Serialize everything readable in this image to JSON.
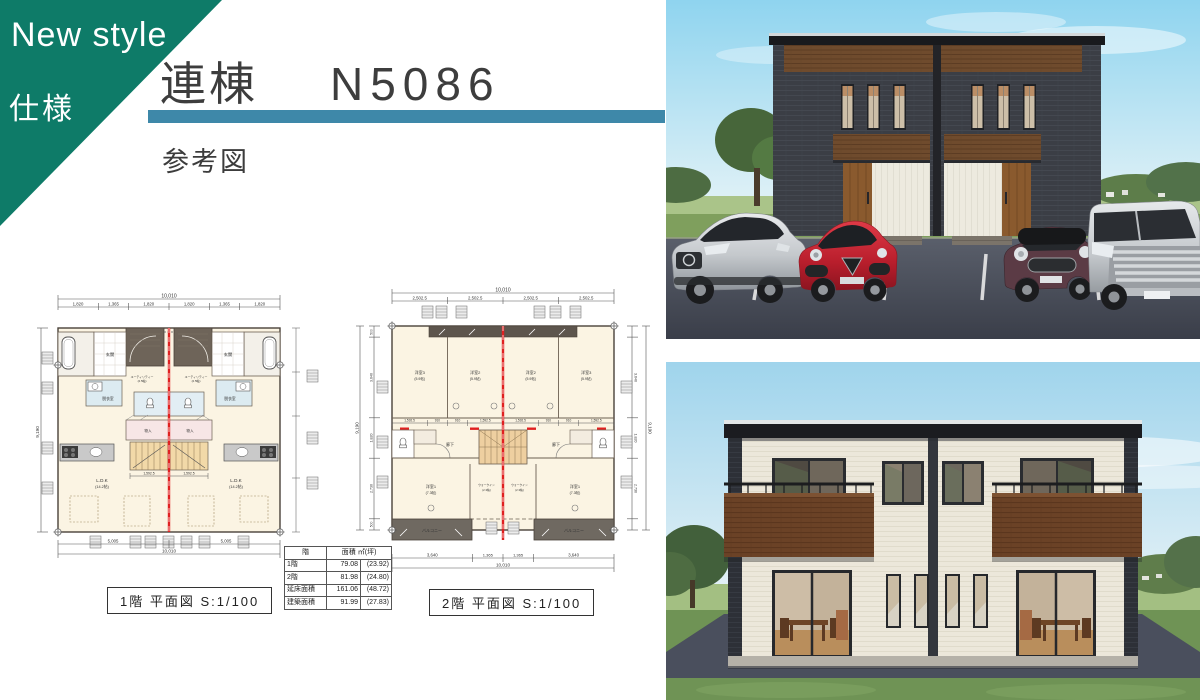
{
  "banner": {
    "line1": "New style",
    "line2": "仕様"
  },
  "header": {
    "title": "連棟",
    "model": "N5086",
    "subtitle": "参考図"
  },
  "colors": {
    "banner_teal": "#0e7b68",
    "bar_blue": "#3e88a9",
    "plan_red": "#e02020",
    "plan_cream": "#fbf4e3",
    "wood_brown": "#6f4b2d",
    "front_wall_charcoal": "#3b3e45",
    "rear_wall_cream": "#ece7da",
    "asphalt": "#454a55",
    "grass": "#6f9355"
  },
  "plan1": {
    "caption": "1階 平面図 S:1/100",
    "total_w": "10,010",
    "total_h": "9,190",
    "seg_top": [
      "1,820",
      "1,365",
      "1,820",
      "1,820",
      "1,365",
      "1,820"
    ],
    "seg_bottom": [
      "5,005",
      "5,005"
    ],
    "inner_dim": "1,592.5",
    "rooms": {
      "genkan": "玄関",
      "utility1": "ユーティリティー",
      "utility2": "(2.5帖)",
      "datsui": "脱衣室",
      "mono": "物入",
      "ldk1": "L.D.K",
      "ldk2": "(14.2帖)"
    }
  },
  "plan2": {
    "caption": "2階 平面図 S:1/100",
    "total_w": "10,010",
    "total_h": "9,190",
    "seg_top": [
      "2,502.5",
      "2,502.5",
      "2,502.5",
      "2,502.5"
    ],
    "seg_left": [
      "500",
      "3,640",
      "1,820",
      "2,730",
      "500"
    ],
    "seg_bottom": [
      "3,640",
      "1,365",
      "1,365",
      "3,640"
    ],
    "mid_dims": [
      "1,592.5",
      "910",
      "910",
      "1,592.5"
    ],
    "rooms": {
      "y3a": "洋室3",
      "y3b": "(5.9帖)",
      "y2a": "洋室2",
      "y2b": "(5.9帖)",
      "y1a": "洋室1",
      "y1b": "(7.3帖)",
      "rouka": "廊下",
      "wia": "ウォークイン",
      "wib": "(2.3帖)",
      "balcony": "バルコニー"
    }
  },
  "area_table": {
    "col1": "階",
    "col2": "面積 ㎡(坪)",
    "rows": [
      {
        "label": "1階",
        "m2": "79.08",
        "tsubo": "(23.92)"
      },
      {
        "label": "2階",
        "m2": "81.98",
        "tsubo": "(24.80)"
      },
      {
        "label": "延床面積",
        "m2": "161.06",
        "tsubo": "(48.72)"
      },
      {
        "label": "建築面積",
        "m2": "91.99",
        "tsubo": "(27.83)"
      }
    ]
  }
}
